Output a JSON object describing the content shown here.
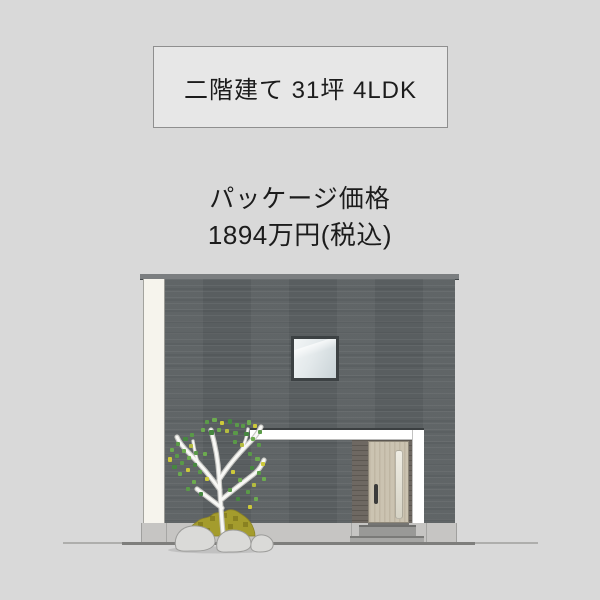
{
  "page": {
    "background_color": "#d9d9d9",
    "text_color": "#1c1c1c"
  },
  "spec_box": {
    "label": "二階建て 31坪 4LDK"
  },
  "price_block": {
    "title": "パッケージ価格",
    "amount": "1894万円(税込)"
  },
  "house_illustration": {
    "colors": {
      "page_bg": "#d9d9d9",
      "box_bg": "#e7e7e7",
      "box_border": "#8f8f8f",
      "text": "#1c1c1c",
      "wall": "#5c6163",
      "cap": "#7b7e80",
      "pillar": "#f6f4ed",
      "canopy": "#ffffff",
      "canopy_edge": "#3b3f41",
      "window_frame": "#3c4143",
      "glass_light": "#f2f5f6",
      "glass_dark": "#c9d3d7",
      "recess": "#6e6862",
      "recess_dark": "#5c5751",
      "door": "#cbc3b1",
      "door_glass": "#efede4",
      "handle": "#3b3b3b",
      "foundation": "#c6c5c3",
      "step": "#999997",
      "ground": "#7e7e7c",
      "trunk": "#f8f8f5",
      "leaf_green": "#5a9a48",
      "leaf_yellow": "#cdc93a",
      "moss": "#a49c2d",
      "rock": "#dadad8"
    }
  }
}
